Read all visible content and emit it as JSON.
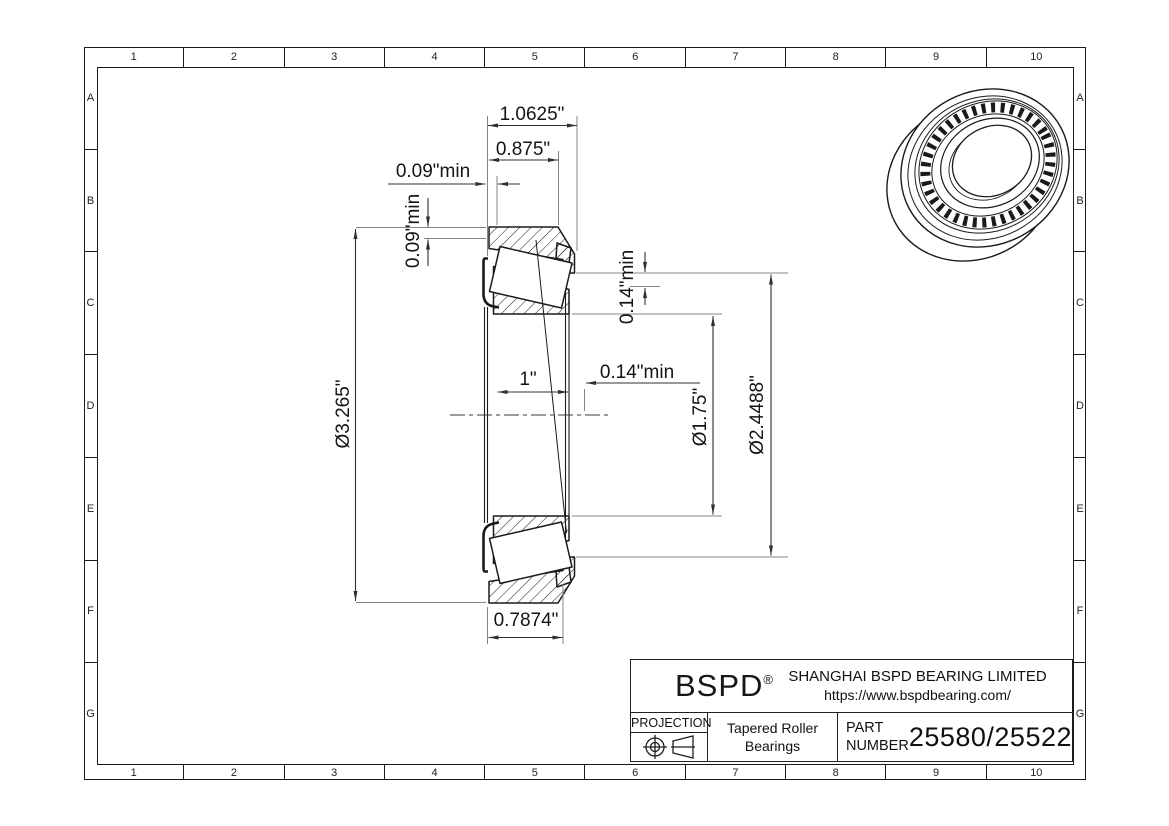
{
  "sheet": {
    "grid": {
      "columns": [
        "1",
        "2",
        "3",
        "4",
        "5",
        "6",
        "7",
        "8",
        "9",
        "10"
      ],
      "rows": [
        "A",
        "B",
        "C",
        "D",
        "E",
        "F",
        "G"
      ]
    },
    "dimensions": {
      "overall_width": "1.0625\"",
      "cup_width_top": "0.875\"",
      "backing_left_horizontal": "0.09\"min",
      "backing_left_vertical": "0.09\"min",
      "outer_diameter": "Ø3.265\"",
      "cone_width": "1\"",
      "backing_right_horizontal": "0.14\"min",
      "backing_right_vertical": "0.14\"min",
      "bore_diameter": "Ø1.75\"",
      "cup_inner_diameter": "Ø2.4488\"",
      "cup_width_bottom": "0.7874\""
    },
    "title_block": {
      "brand": "BSPD",
      "registered_mark": "®",
      "company": "SHANGHAI BSPD BEARING LIMITED",
      "website": "https://www.bspdbearing.com/",
      "projection_label": "PROJECTION",
      "product_line1": "Tapered Roller",
      "product_line2": "Bearings",
      "part_label_line1": "PART",
      "part_label_line2": "NUMBER",
      "part_number": "25580/25522"
    },
    "colors": {
      "object_line": "#1a1a1a",
      "dimension_line": "#2f2f2f",
      "extension_line": "#848484",
      "background": "#ffffff"
    }
  }
}
